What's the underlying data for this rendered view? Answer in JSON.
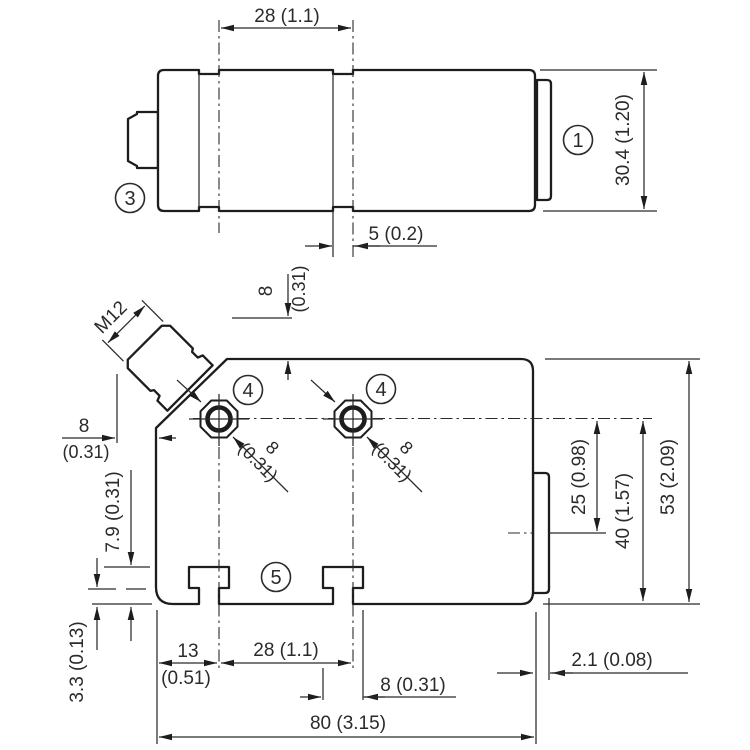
{
  "callouts": {
    "one": "1",
    "three": "3",
    "four_a": "4",
    "four_b": "4",
    "five": "5"
  },
  "top_view": {
    "width_dim": "28 (1.1)",
    "height_dim": "30.4 (1.20)",
    "groove_dim": "5 (0.2)"
  },
  "front_view": {
    "thread": "M12",
    "conn_top_offset": {
      "value": "8",
      "inch": "(0.31)"
    },
    "conn_left_offset": {
      "value": "8",
      "inch": "(0.31)"
    },
    "hole1_dim": {
      "value": "8",
      "inch": "(0.31)"
    },
    "hole2_dim": {
      "value": "8",
      "inch": "(0.31)"
    },
    "slot_depth_dim": "7.9 (0.31)",
    "step_dim": "3.3 (0.13)",
    "slot_offset": {
      "value": "13",
      "inch": "(0.51)"
    },
    "slot_pitch_dim": "28 (1.1)",
    "slot_width_dim": "8 (0.31)",
    "overall_width_dim": "80 (3.15)",
    "flange_thickness_dim": "2.1 (0.08)",
    "flange_center_dim": "25 (0.98)",
    "hole_axis_dim": "40 (1.57)",
    "overall_height_dim": "53 (2.09)"
  }
}
